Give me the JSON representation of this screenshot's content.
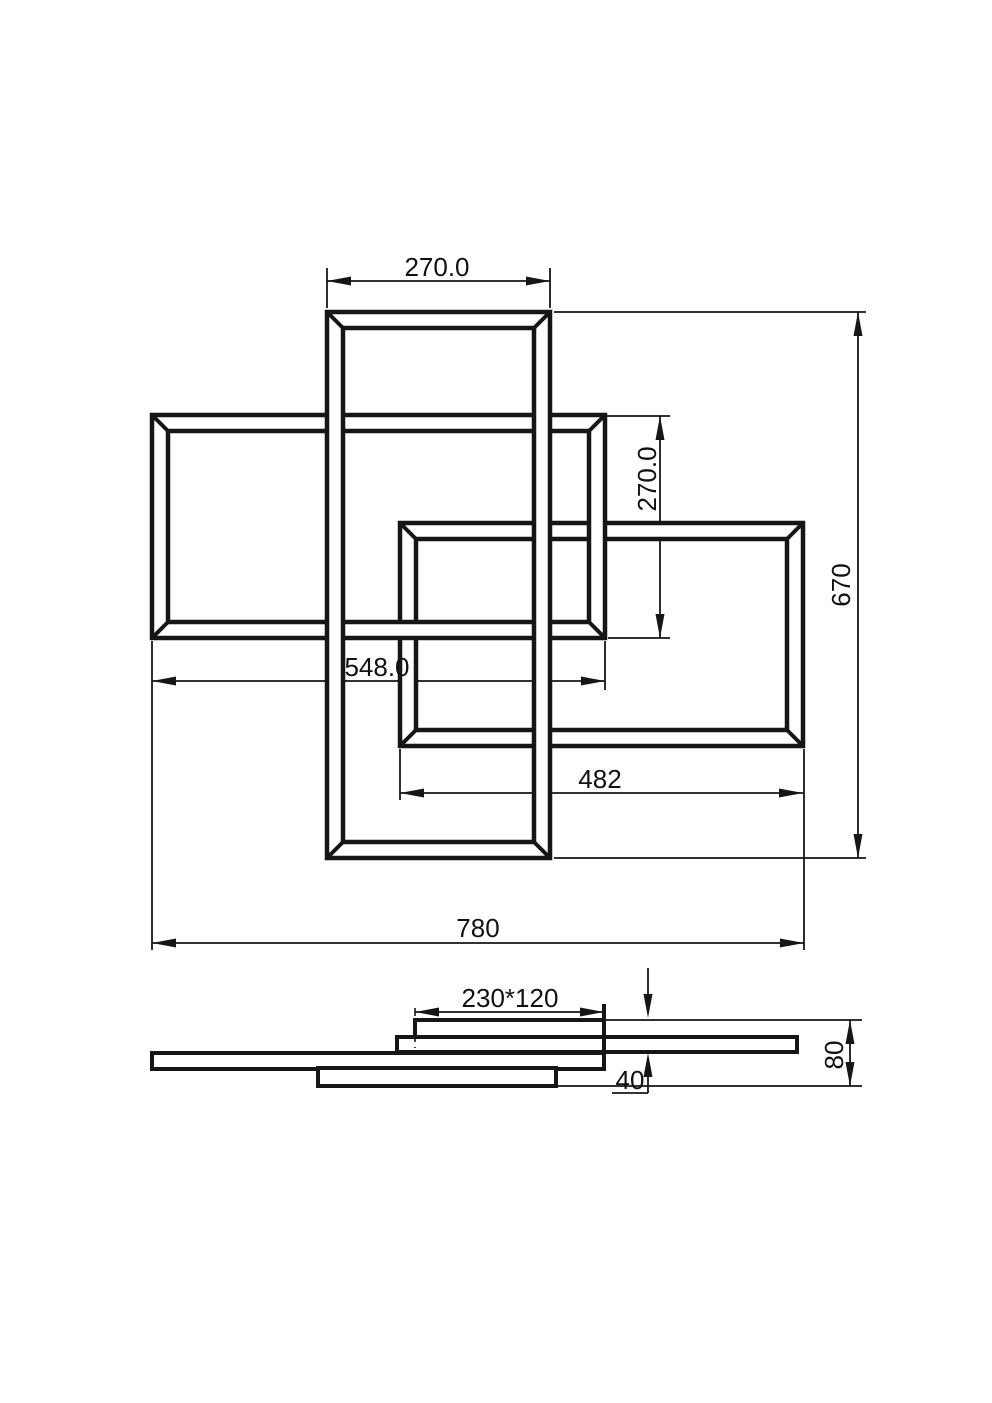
{
  "page": {
    "background": "#ffffff",
    "line_color": "#161616"
  },
  "views": {
    "top_view": {
      "dims": {
        "top_width": "270.0",
        "left_rect_height": "270.0",
        "overall_height": "670",
        "left_rect_width": "548.0",
        "right_rect_width": "482",
        "overall_width": "780"
      }
    },
    "side_view": {
      "dims": {
        "canopy": "230*120",
        "overall_height": "80",
        "offset": "40"
      }
    }
  }
}
